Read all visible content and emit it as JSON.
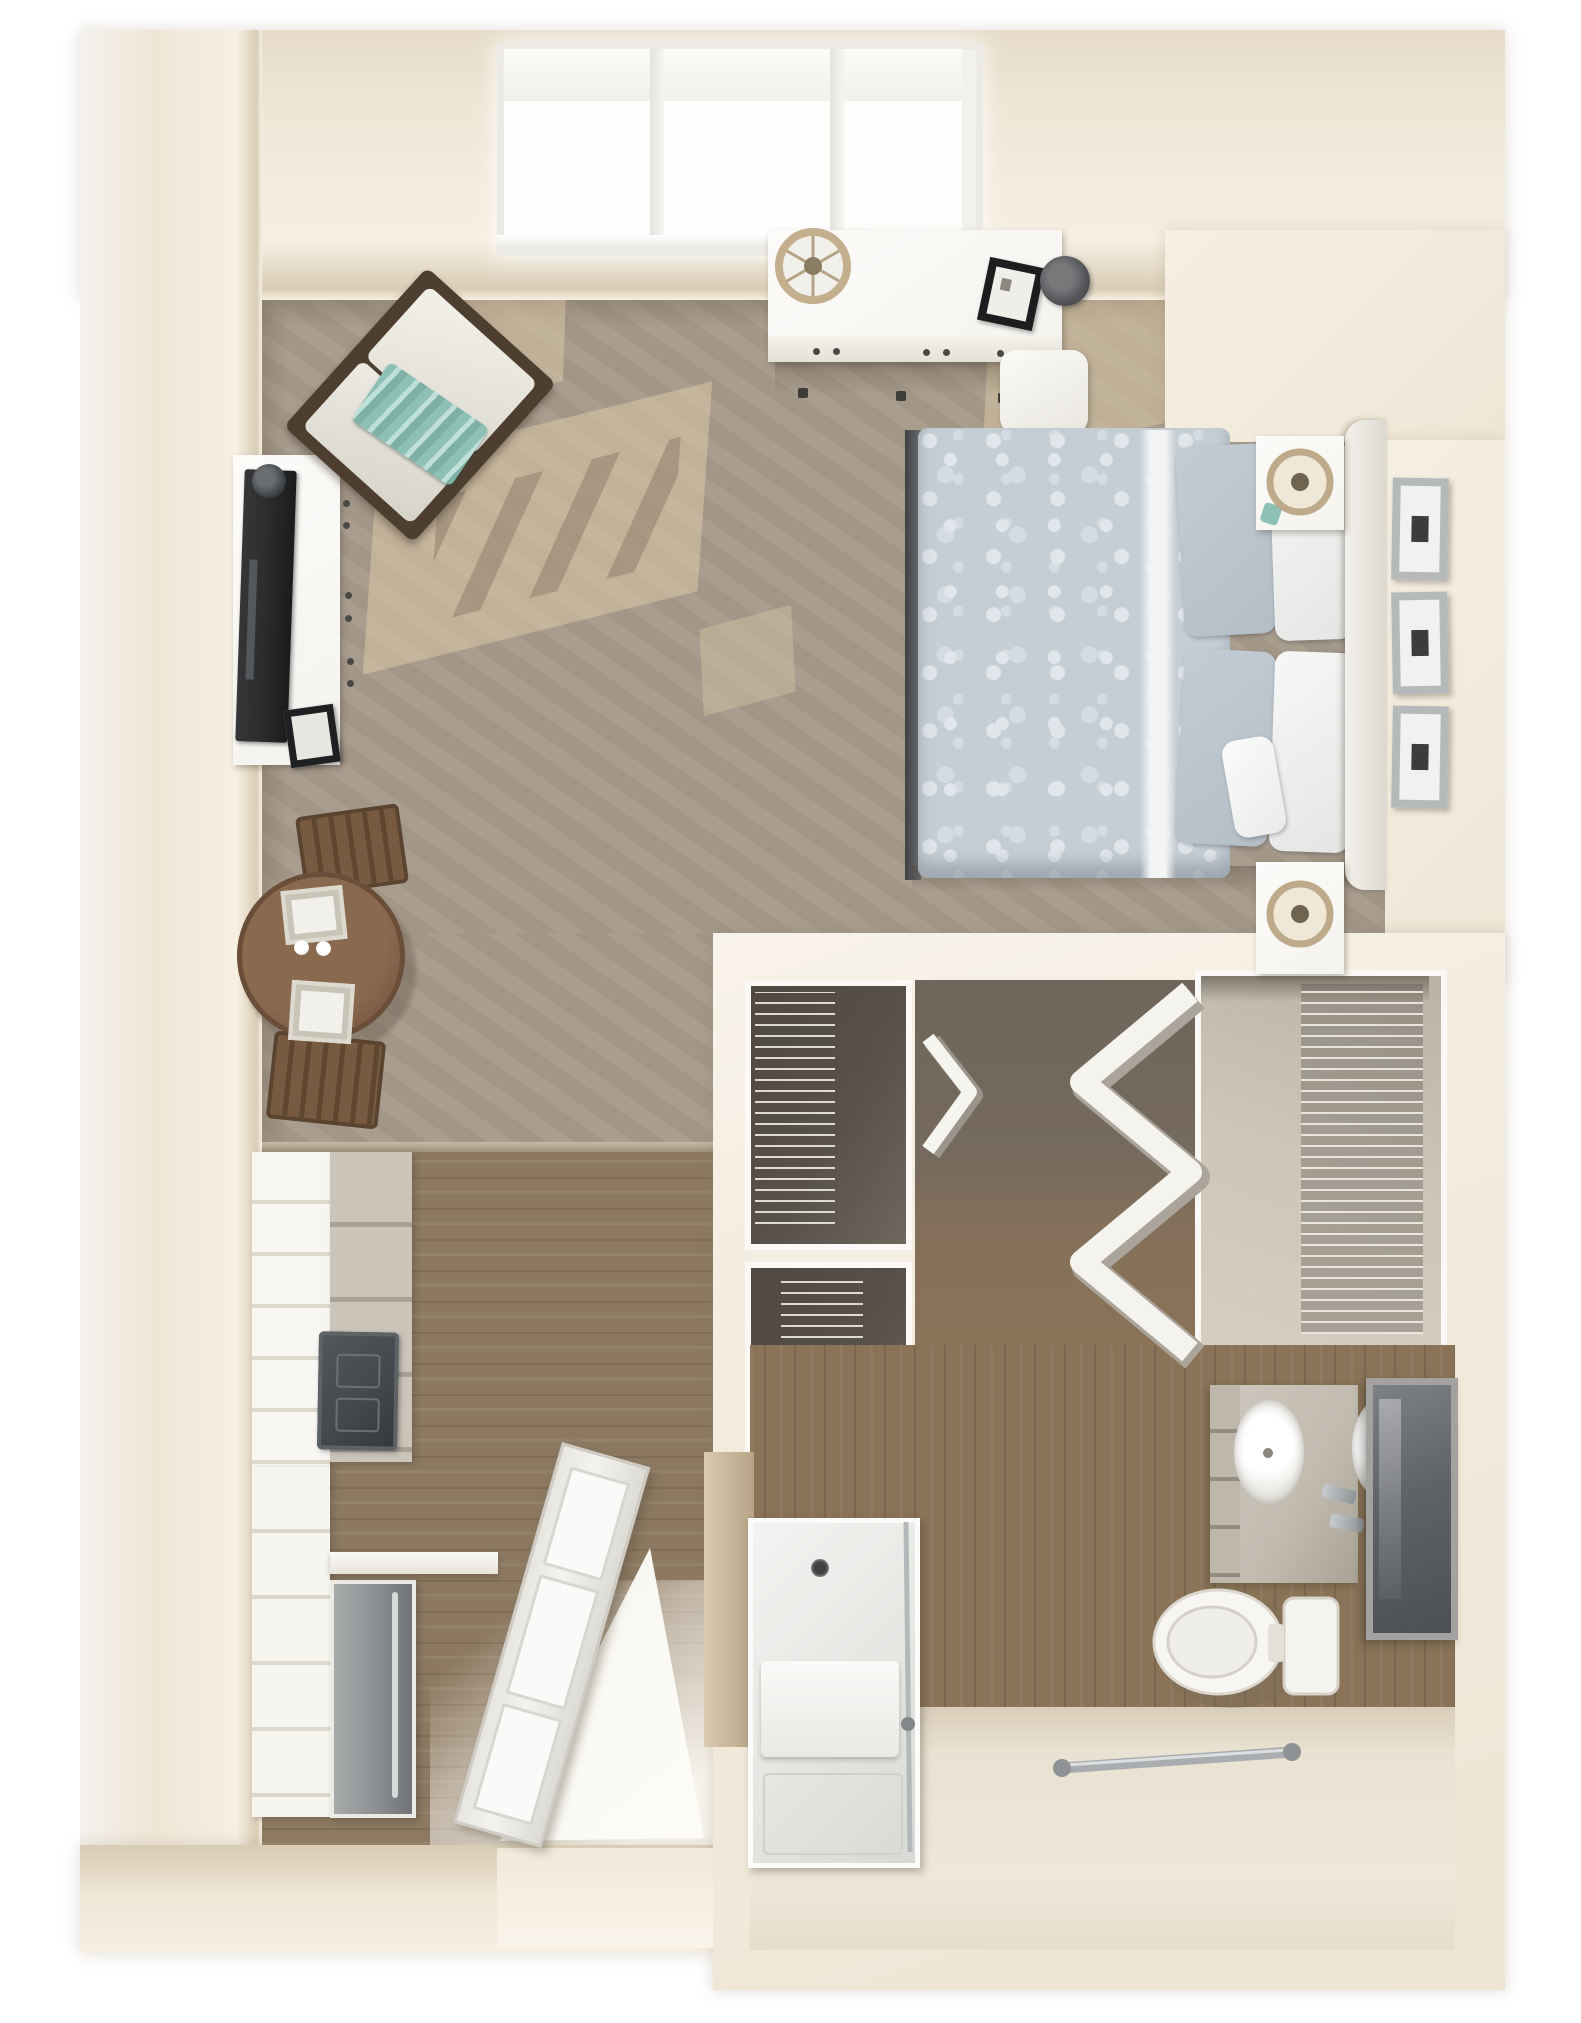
{
  "scene": {
    "title": "3D top-view floor plan of a studio apartment",
    "view": "top-down dollhouse render",
    "rooms": [
      {
        "id": "living-sleeping",
        "label": "Living and sleeping area with carpet"
      },
      {
        "id": "kitchenette",
        "label": "Kitchenette with wood floor"
      },
      {
        "id": "entry",
        "label": "Entry with open door"
      },
      {
        "id": "closets",
        "label": "Closet area with wire shelving"
      },
      {
        "id": "bathroom",
        "label": "Bathroom with double vanity and roll-in shower"
      }
    ]
  },
  "palette": {
    "wall": "#efe6d6",
    "wallFace": "#f6efe2",
    "wallEdge": "#e6dcc8",
    "wallEdge2": "#d9cdb6",
    "cream": "#f2ebdd",
    "carpet": "#a69a8b",
    "sun": "#dcc9a7",
    "wood": "#8d7961",
    "bathWood": "#8a7356",
    "tile": "#e9e1d1",
    "white": "#f5f3ee",
    "duvet": "#c5ced5",
    "duvetLight": "#e0e6ea",
    "pillowBlue": "#b3bec7",
    "teal": "#8fc0b5",
    "tableWood": "#7b5a42",
    "chairWood": "#6e5138",
    "tv": "#2b2d2f",
    "stainless": "#8f9294",
    "counterGrey": "#c1bbb0",
    "cooktop": "#45494d",
    "mirror": "#5f6266",
    "chrome": "#aab0b3",
    "frameSilver": "#b6b9ba",
    "dark": "#3a3c3e",
    "hallShadow": "#756a5d",
    "cubby": "#58514a",
    "closetInner": "#cbc4b7"
  },
  "furniture": {
    "windows": {
      "label": "Window wall with three panes"
    },
    "desk": {
      "label": "White desk under windows"
    },
    "desk_lamp": {
      "label": "Round desk lamp"
    },
    "desk_chair": {
      "label": "White desk chair"
    },
    "desk_frame": {
      "label": "Black picture frame on desk"
    },
    "desk_hat": {
      "label": "Dark round box on desk"
    },
    "armchair": {
      "label": "Accent armchair with teal throw blanket"
    },
    "tv_console": {
      "label": "White TV console"
    },
    "tv": {
      "label": "Flat-screen TV"
    },
    "console_frame": {
      "label": "Black picture frame on console"
    },
    "dining_table": {
      "label": "Round wood dining table set for two"
    },
    "dining_chair_top": {
      "label": "Dining chair"
    },
    "dining_chair_bottom": {
      "label": "Dining chair"
    },
    "bed": {
      "label": "Bed with blue floral duvet"
    },
    "headboard": {
      "label": "White headboard"
    },
    "nightstand_upper": {
      "label": "Nightstand with lamp"
    },
    "nightstand_lower": {
      "label": "Nightstand with lamp"
    },
    "wall_frames": {
      "label": "Three framed artworks beside bed"
    },
    "fridge": {
      "label": "Tall white cabinet / refrigerator"
    },
    "counter": {
      "label": "Kitchen counter"
    },
    "cooktop": {
      "label": "Dark cooktop"
    },
    "dishwasher": {
      "label": "Stainless dishwasher"
    },
    "entry_door": {
      "label": "Open entry door"
    },
    "wire_closet_1": {
      "label": "Closet with wire shelving"
    },
    "wire_closet_2": {
      "label": "Closet with wire shelving"
    },
    "bifold_door": {
      "label": "Bi-fold closet door"
    },
    "accordion_door": {
      "label": "Accordion closet doors"
    },
    "walk_in_closet": {
      "label": "Closet with wire shelving"
    },
    "vanity": {
      "label": "Double-sink vanity"
    },
    "mirror": {
      "label": "Vanity mirror"
    },
    "toilet": {
      "label": "Toilet"
    },
    "shower": {
      "label": "Roll-in shower with bench and glass door"
    },
    "grab_bar": {
      "label": "Grab bar"
    }
  }
}
